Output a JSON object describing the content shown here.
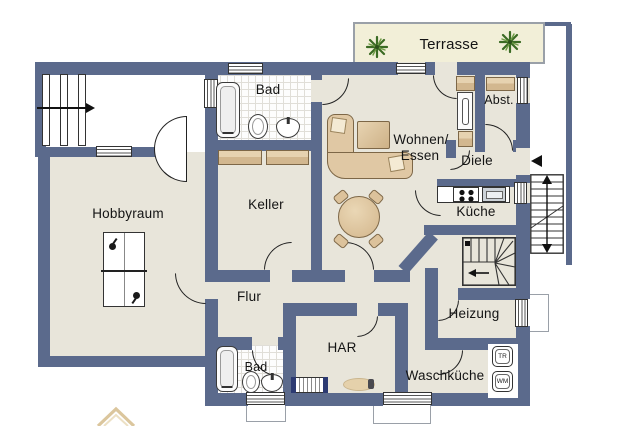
{
  "floorplan": {
    "rooms": {
      "terrasse": "Terrasse",
      "bad_upper": "Bad",
      "wohnen_essen_line1": "Wohnen/",
      "wohnen_essen_line2": "Essen",
      "abstellraum": "Abst.",
      "diele": "Diele",
      "kueche": "Küche",
      "keller": "Keller",
      "hobbyraum": "Hobbyraum",
      "flur": "Flur",
      "har": "HAR",
      "heizung": "Heizung",
      "waschkueche": "Waschküche",
      "bad_lower": "Bad"
    },
    "appliances": {
      "dryer": "TR",
      "washer": "WM"
    },
    "colors": {
      "wall": "#5b6a8c",
      "floor": "#e8e5da",
      "terrace_floor": "#f2efd8",
      "furniture_wood": "#d8be99",
      "plant_green": "#3b6b24",
      "bath_tile": "#ffffff"
    }
  }
}
